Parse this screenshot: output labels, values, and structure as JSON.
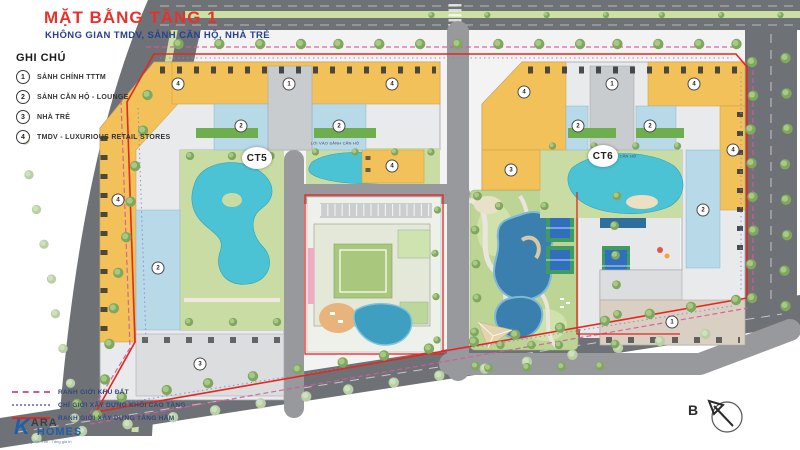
{
  "header": {
    "title": "MẶT BẰNG TẦNG 1",
    "subtitle": "KHÔNG GIAN TMDV, SẢNH CĂN HỘ, NHÀ TRẺ"
  },
  "legend": {
    "heading": "GHI CHÚ",
    "items": [
      {
        "num": "1",
        "label": "SẢNH CHÍNH TTTM"
      },
      {
        "num": "2",
        "label": "SẢNH CĂN HỘ - LOUNGE"
      },
      {
        "num": "3",
        "label": "NHÀ TRẺ"
      },
      {
        "num": "4",
        "label": "TMDV - LUXURIOUS RETAIL STORES"
      }
    ],
    "lines": [
      {
        "label": "RANH GIỚI KHU ĐẤT"
      },
      {
        "label": "CHỈ GIỚI XÂY DỰNG KHỐI CAO TẦNG"
      },
      {
        "label": "RANH GIỚI XÂY DỰNG TẦNG HẦM"
      }
    ]
  },
  "plan": {
    "blocks": [
      {
        "label": "CT5"
      },
      {
        "label": "CT6"
      }
    ],
    "entry_label_ct5": "LỐI VÀO SẢNH CĂN HỘ",
    "entry_label_ct6": "LỐI VÀO SẢNH CĂN HỘ",
    "badges": [
      {
        "n": "4",
        "x": 178,
        "y": 84
      },
      {
        "n": "1",
        "x": 289,
        "y": 84
      },
      {
        "n": "4",
        "x": 392,
        "y": 84
      },
      {
        "n": "2",
        "x": 241,
        "y": 126
      },
      {
        "n": "2",
        "x": 339,
        "y": 126
      },
      {
        "n": "4",
        "x": 118,
        "y": 200
      },
      {
        "n": "2",
        "x": 158,
        "y": 268
      },
      {
        "n": "3",
        "x": 200,
        "y": 364
      },
      {
        "n": "4",
        "x": 392,
        "y": 166
      },
      {
        "n": "4",
        "x": 524,
        "y": 92
      },
      {
        "n": "1",
        "x": 612,
        "y": 84
      },
      {
        "n": "4",
        "x": 694,
        "y": 84
      },
      {
        "n": "2",
        "x": 578,
        "y": 126
      },
      {
        "n": "2",
        "x": 650,
        "y": 126
      },
      {
        "n": "3",
        "x": 511,
        "y": 170
      },
      {
        "n": "4",
        "x": 733,
        "y": 150
      },
      {
        "n": "2",
        "x": 703,
        "y": 210
      },
      {
        "n": "1",
        "x": 672,
        "y": 322
      }
    ]
  },
  "compass": {
    "label": "B"
  },
  "logo": {
    "prefix": "K",
    "name_top": "ARA",
    "name_bottom": "HOMES",
    "tagline": "Xây niềm tin - Tăng giá trị"
  },
  "colors": {
    "accent_red": "#e5271f",
    "title_red": "#e8312a",
    "navy": "#27408f",
    "boundary_pink": "#d9569b",
    "boundary_purple": "#8f86c9",
    "building_yellow": "#f2c15a",
    "lobby_blue": "#b7d9e8",
    "pool_teal": "#4cc3d5",
    "park_green": "#bcd494"
  }
}
